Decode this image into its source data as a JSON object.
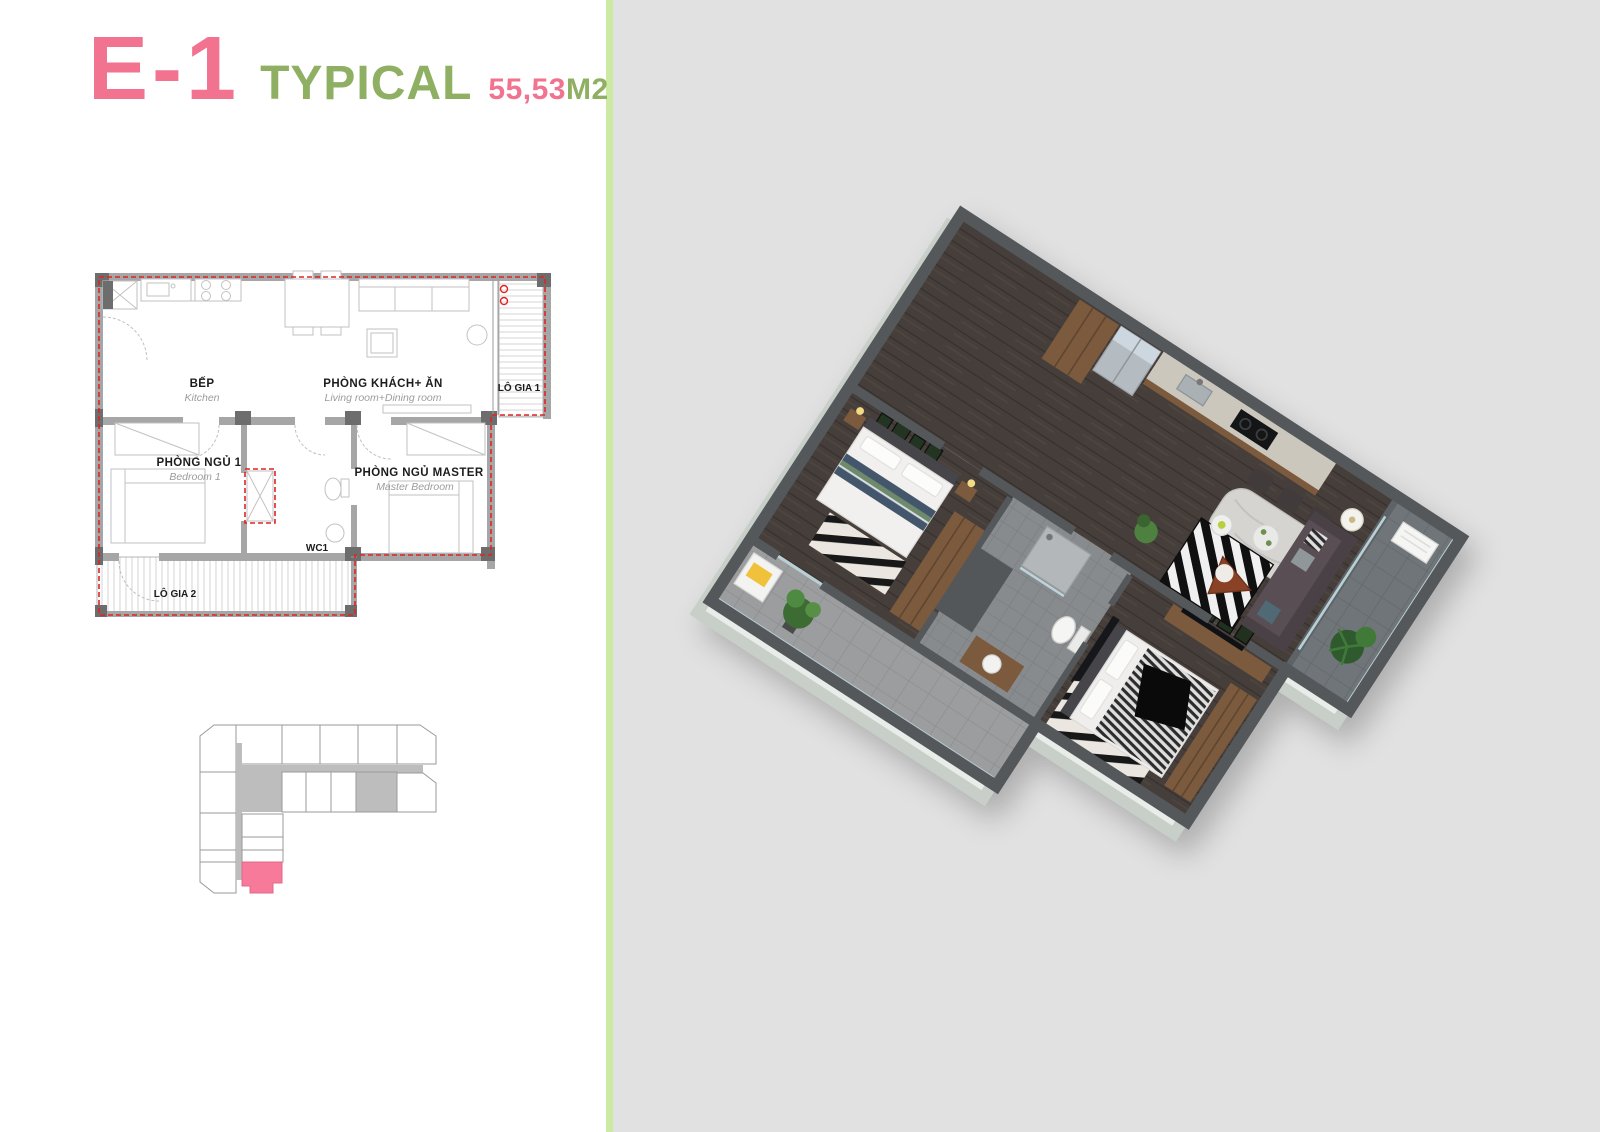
{
  "header": {
    "unit_code": "E-1",
    "type_label": "TYPICAL",
    "area_value": "55,53",
    "area_unit": "M2"
  },
  "colors": {
    "title_pink": "#f1738f",
    "title_green": "#8fb062",
    "divider_green": "#cdeaa5",
    "panel_gray": "#e1e1e1",
    "plan_outline_red": "#e02424",
    "plan_wall_gray": "#a6a6a6",
    "keyplan_highlight": "#f87a9a",
    "keyplan_corridor": "#bdbdbd",
    "render_wall": "#54585b",
    "render_wall_face": "#e9ede9",
    "wood": "#7b5a3d",
    "floor_wood": "#463e3a"
  },
  "floorplan": {
    "kitchen": {
      "vi": "BẾP",
      "en": "Kitchen"
    },
    "living": {
      "vi": "PHÒNG KHÁCH+ ĂN",
      "en": "Living room+Dining room"
    },
    "balcony1": {
      "vi": "LÔ GIA 1"
    },
    "bedroom1": {
      "vi": "PHÒNG NGỦ 1",
      "en": "Bedroom 1"
    },
    "wc": {
      "vi": "WC1"
    },
    "master": {
      "vi": "PHÒNG NGỦ MASTER",
      "en": "Master Bedroom"
    },
    "balcony2": {
      "vi": "LÔ GIA 2"
    }
  }
}
